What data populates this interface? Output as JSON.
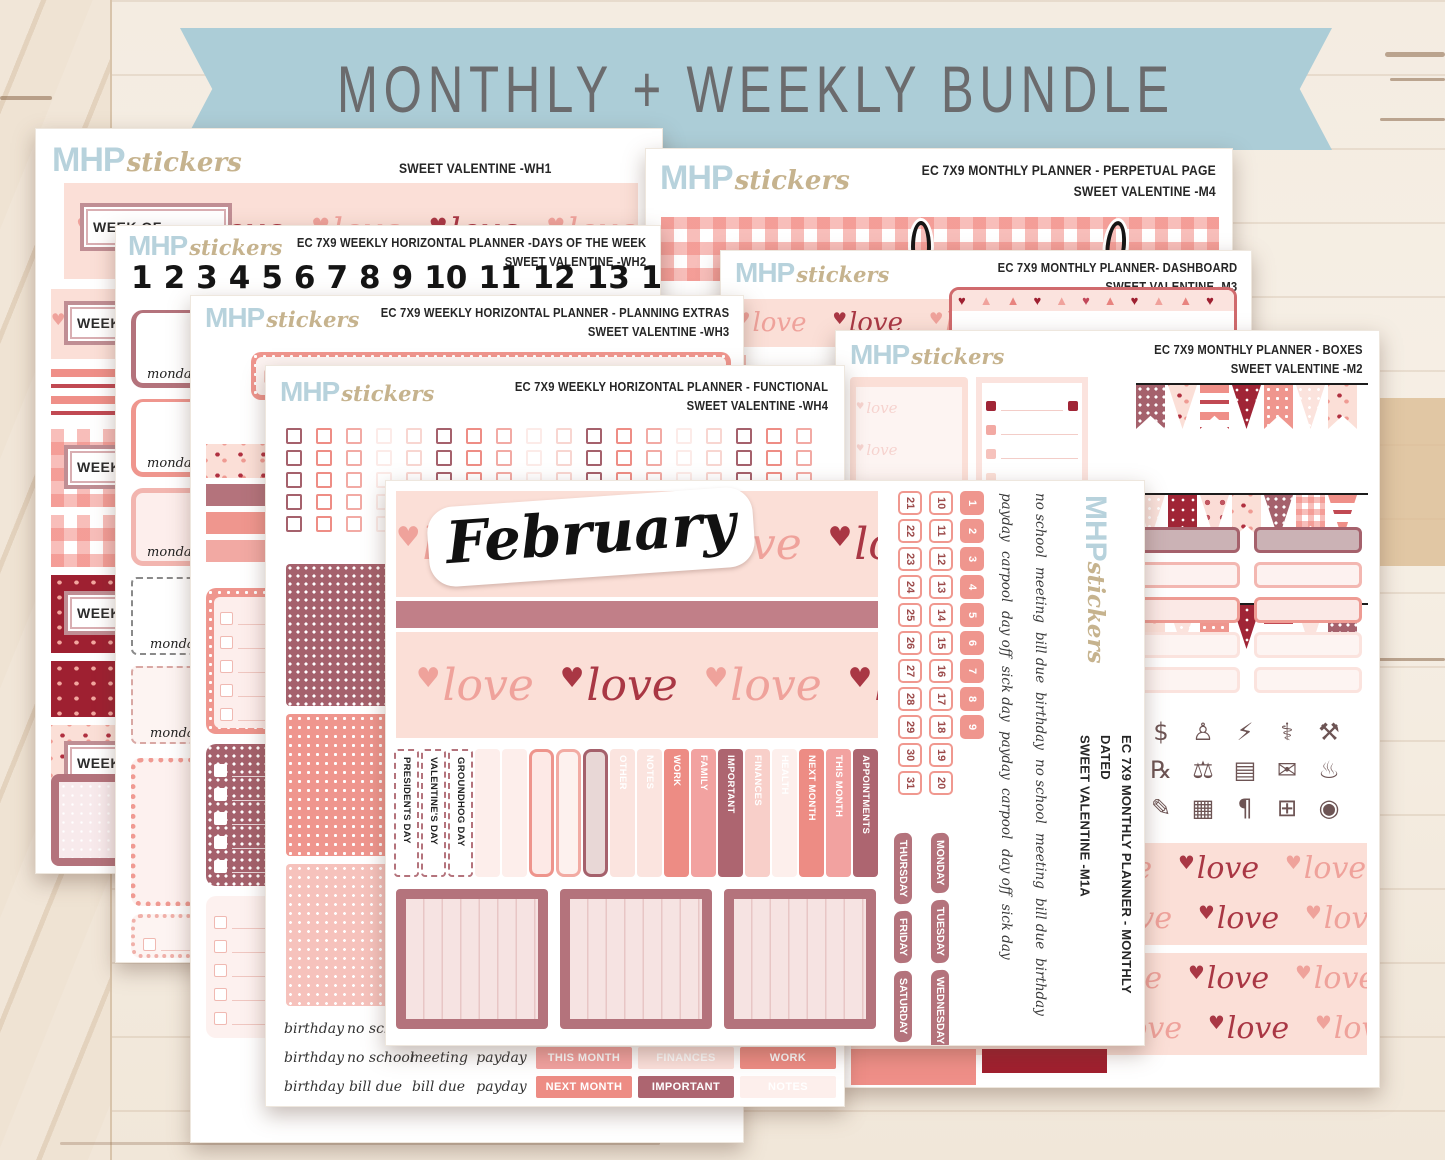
{
  "banner": {
    "label": "MONTHLY + WEEKLY BUNDLE"
  },
  "brand": {
    "mhp": "MHP",
    "stickers": "stickers"
  },
  "palette": {
    "banner_blue": "#accdd7",
    "banner_text": "#6b6b6d",
    "logo_blue": "#b7d2dc",
    "logo_tan": "#c6b38e",
    "title_ink": "#262626",
    "pink_bg": "#fbdfd7",
    "salmon": "#ee8d85",
    "pink": "#f2a2a0",
    "mauve": "#b4737c",
    "dark_mauve": "#ad6570",
    "dark_red": "#9e2031",
    "wood": "#f4ece1"
  },
  "love": {
    "items": [
      {
        "h": "♥",
        "w": "love",
        "c": "lv-b"
      },
      {
        "h": "♥",
        "w": "love",
        "c": "lv-a"
      },
      {
        "h": "♥",
        "w": "love",
        "c": "lv-b"
      },
      {
        "h": "♥",
        "w": "love",
        "c": "lv-a"
      },
      {
        "h": "♥",
        "w": "love",
        "c": "lv-b"
      },
      {
        "h": "♥",
        "w": "love",
        "c": "lv-a"
      }
    ],
    "faint_items": [
      {
        "h": "♥",
        "w": "love",
        "c": "lv-faint"
      },
      {
        "h": "♥",
        "w": "love",
        "c": "lv-faint"
      },
      {
        "h": "♥",
        "w": "love",
        "c": "lv-faint"
      }
    ]
  },
  "sheets": {
    "wh1": {
      "code_line": "SWEET VALENTINE -WH1",
      "week_of": "WEEK OF"
    },
    "wh2": {
      "line1": "EC 7X9 WEEKLY HORIZONTAL PLANNER -DAYS OF THE WEEK",
      "line2": "SWEET VALENTINE -WH2",
      "numbers": [
        "1",
        "2",
        "3",
        "4",
        "5",
        "6",
        "7",
        "8",
        "9",
        "10",
        "11",
        "12",
        "13",
        "14",
        "15",
        "16",
        "17",
        "18"
      ],
      "monday": "monday",
      "monday_variants": [
        {
          "s": "mv1"
        },
        {
          "s": "mv2"
        },
        {
          "s": "mv3"
        },
        {
          "s": "mv4"
        },
        {
          "s": "mv5"
        }
      ]
    },
    "wh3": {
      "line1": "EC 7X9 WEEKLY HORIZONTAL PLANNER - PLANNING EXTRAS",
      "line2": "SWEET VALENTINE -WH3",
      "mon": "MON"
    },
    "wh4": {
      "line1": "EC 7X9 WEEKLY HORIZONTAL PLANNER - FUNCTIONAL",
      "line2": "SWEET VALENTINE -WH4",
      "grid_cols": [
        {
          "s": "g-mauve"
        },
        {
          "s": "g-salmon"
        },
        {
          "s": "g-pink"
        },
        {
          "s": "g-faint"
        },
        {
          "s": "g-vlight"
        },
        {
          "s": "g-mauve"
        },
        {
          "s": "g-salmon"
        },
        {
          "s": "g-pink"
        },
        {
          "s": "g-faint"
        },
        {
          "s": "g-vlight"
        },
        {
          "s": "g-mauve"
        },
        {
          "s": "g-salmon"
        },
        {
          "s": "g-pink"
        },
        {
          "s": "g-faint"
        },
        {
          "s": "g-vlight"
        },
        {
          "s": "g-mauve"
        },
        {
          "s": "g-salmon"
        },
        {
          "s": "g-pink"
        }
      ],
      "bottom_rows": [
        {
          "w1": "birthday",
          "w2": "no school",
          "w3": "meeting",
          "w4": "payday",
          "l1": "APPOINTMENTS",
          "s1": "lb-dark",
          "l2": "HEALTH",
          "s2": "lb-faint",
          "l3": "FAMILY",
          "s3": "lb-lightpink"
        },
        {
          "w1": "birthday",
          "w2": "no school",
          "w3": "meeting",
          "w4": "payday",
          "l1": "THIS MONTH",
          "s1": "lb-pink",
          "l2": "FINANCES",
          "s2": "lb-vlight",
          "l3": "WORK",
          "s3": "lb-salmon"
        },
        {
          "w1": "birthday",
          "w2": "bill due",
          "w3": "bill due",
          "w4": "payday",
          "l1": "NEXT MONTH",
          "s1": "lb-salmon",
          "l2": "IMPORTANT",
          "s2": "lb-dark",
          "l3": "NOTES",
          "s3": "lb-faint"
        }
      ]
    },
    "m4": {
      "line1": "EC 7X9 MONTHLY PLANNER - PERPETUAL PAGE",
      "line2": "SWEET VALENTINE -M4"
    },
    "m3": {
      "line1": "EC 7X9 MONTHLY PLANNER- DASHBOARD",
      "line2": "SWEET VALENTINE -M3"
    },
    "m2": {
      "line1": "EC 7X9 MONTHLY PLANNER - BOXES",
      "line2": "SWEET VALENTINE -M2",
      "bunting_r1": [
        {
          "p": "dot-mauve-dk",
          "s": "f-tail"
        },
        {
          "p": "pink-hearts",
          "s": "f-tri"
        },
        {
          "p": "stripes",
          "s": "f-tail"
        },
        {
          "p": "p-red",
          "s": "f-tri"
        },
        {
          "p": "dot-salmon",
          "s": "f-tail"
        },
        {
          "p": "dot-light",
          "s": "f-tri"
        },
        {
          "p": "pink-hearts",
          "s": "f-tail"
        }
      ],
      "bunting_r2": [
        {
          "p": "dot-light",
          "s": "f-tail"
        },
        {
          "p": "p-red",
          "s": "f-tri"
        },
        {
          "p": "dotred-big",
          "s": "f-tail"
        },
        {
          "p": "pink-hearts",
          "s": "f-tri"
        },
        {
          "p": "dot-mauve-dk",
          "s": "f-tail"
        },
        {
          "p": "gingham-sm",
          "s": "f-tri"
        },
        {
          "p": "stripes",
          "s": "f-tail"
        }
      ],
      "bunting_r3": [
        {
          "p": "pink-hearts",
          "s": "f-tail"
        },
        {
          "p": "dot-light",
          "s": "f-tri"
        },
        {
          "p": "dot-salmon",
          "s": "f-tail"
        },
        {
          "p": "p-red",
          "s": "f-tri"
        },
        {
          "p": "stripes",
          "s": "f-tail"
        },
        {
          "p": "p-love",
          "s": "f-tri"
        },
        {
          "p": "dot-mauve-dk",
          "s": "f-tail"
        }
      ],
      "box_rows": [
        {
          "s": "bx-fill"
        },
        {
          "s": "bx-pink"
        },
        {
          "s": "bx-salmon"
        },
        {
          "s": "bx-faint"
        },
        {
          "s": "bx-faint"
        }
      ],
      "icons": [
        {
          "n": "scissors-icon",
          "g": "✂"
        },
        {
          "n": "piggy-bank-icon",
          "g": "$"
        },
        {
          "n": "tooth-icon",
          "g": "♙"
        },
        {
          "n": "gas-pump-icon",
          "g": "⚡"
        },
        {
          "n": "stethoscope-icon",
          "g": "⚕"
        },
        {
          "n": "dumbbell-icon",
          "g": "⚒"
        },
        {
          "n": "washing-machine-icon",
          "g": "⚙"
        },
        {
          "n": "medicine-icon",
          "g": "℞"
        },
        {
          "n": "scale-icon",
          "g": "⚖"
        },
        {
          "n": "luggage-icon",
          "g": "▤"
        },
        {
          "n": "envelope-icon",
          "g": "✉"
        },
        {
          "n": "candle-icon",
          "g": "♨"
        },
        {
          "n": "trash-can-icon",
          "g": "♻"
        },
        {
          "n": "journal-icon",
          "g": "✎"
        },
        {
          "n": "package-icon",
          "g": "▦"
        },
        {
          "n": "receipt-icon",
          "g": "¶"
        },
        {
          "n": "shopping-cart-icon",
          "g": "⊞"
        },
        {
          "n": "shoe-icon",
          "g": "◉"
        }
      ]
    },
    "m1a": {
      "line1": "EC 7X9 MONTHLY PLANNER - MONTHLY DATED",
      "line2": "SWEET VALENTINE -M1A",
      "month": "February",
      "tabs": [
        {
          "t": "PRESIDENTS DAY",
          "s": "t-hol"
        },
        {
          "t": "VALENTINE'S DAY",
          "s": "t-hol"
        },
        {
          "t": "GROUNDHOG DAY",
          "s": "t-hol"
        },
        {
          "t": "",
          "s": "t-blank1"
        },
        {
          "t": "",
          "s": "t-blank1"
        },
        {
          "t": "",
          "s": "t-out-salmon"
        },
        {
          "t": "",
          "s": "t-out-salmon2"
        },
        {
          "t": "",
          "s": "t-out-mauve"
        },
        {
          "t": "OTHER",
          "s": "t-vlight"
        },
        {
          "t": "NOTES",
          "s": "t-vlight"
        },
        {
          "t": "WORK",
          "s": "t-salmon"
        },
        {
          "t": "FAMILY",
          "s": "t-pink"
        },
        {
          "t": "IMPORTANT",
          "s": "t-dark"
        },
        {
          "t": "FINANCES",
          "s": "t-lightpink"
        },
        {
          "t": "HEALTH",
          "s": "t-faint"
        },
        {
          "t": "NEXT MONTH",
          "s": "t-salmon"
        },
        {
          "t": "THIS MONTH",
          "s": "t-pink"
        },
        {
          "t": "APPOINTMENTS",
          "s": "t-dark"
        }
      ],
      "dates_21_31": [
        "21",
        "22",
        "23",
        "24",
        "25",
        "26",
        "27",
        "28",
        "29",
        "30",
        "31"
      ],
      "dates_10_20": [
        "10",
        "11",
        "12",
        "13",
        "14",
        "15",
        "16",
        "17",
        "18",
        "19",
        "20"
      ],
      "dates_1_9": [
        "1",
        "2",
        "3",
        "4",
        "5",
        "6",
        "7",
        "8",
        "9"
      ],
      "words_a": [
        "payday",
        "carpool",
        "day off",
        "sick day",
        "payday",
        "carpool",
        "day off",
        "sick day"
      ],
      "words_b": [
        "no school",
        "meeting",
        "bill due",
        "birthday",
        "no school",
        "meeting",
        "bill due",
        "birthday"
      ],
      "day_col1": [
        "THURSDAY",
        "FRIDAY",
        "SATURDAY",
        "SUNDAY"
      ],
      "day_col2": [
        "MONDAY",
        "TUESDAY",
        "WEDNESDAY"
      ]
    }
  }
}
